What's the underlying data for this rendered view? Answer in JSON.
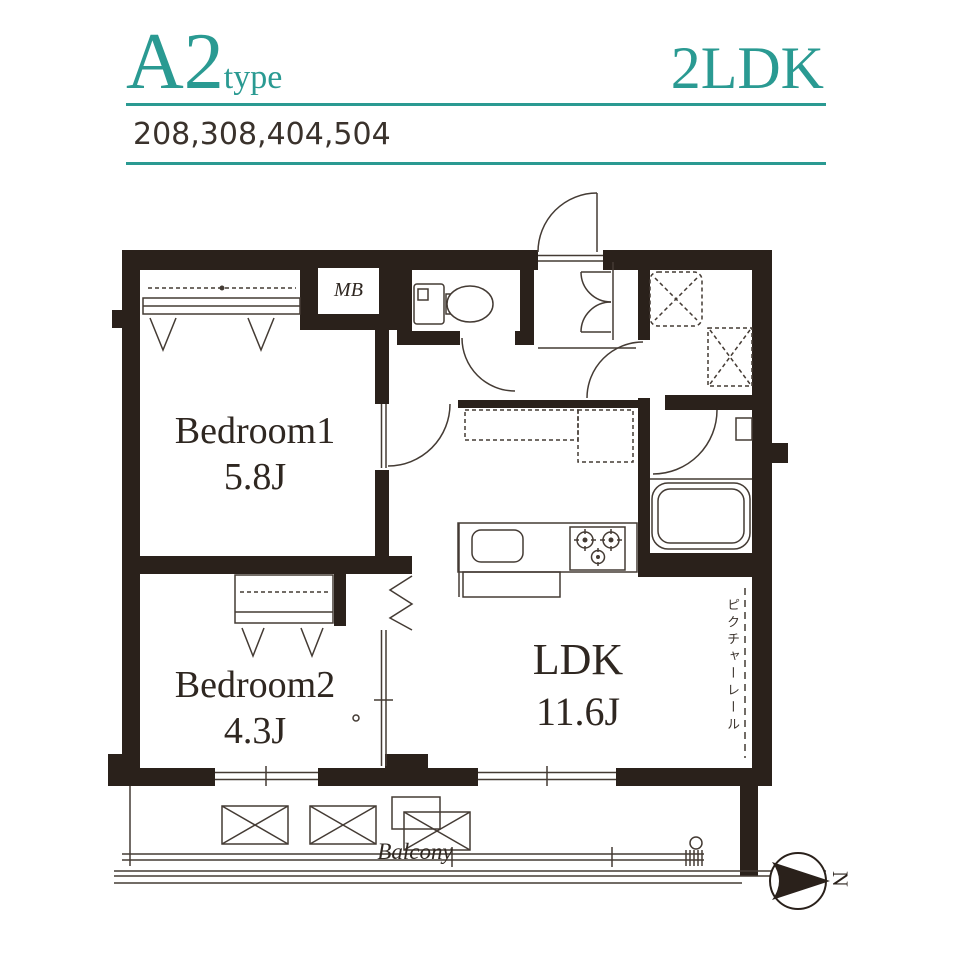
{
  "header": {
    "plan_code": "A2",
    "plan_code_suffix": "type",
    "layout_type": "2LDK",
    "unit_numbers": "208,308,404,504"
  },
  "plan": {
    "labels": {
      "mb": "MB",
      "bedroom1_name": "Bedroom1",
      "bedroom1_size": "5.8J",
      "bedroom2_name": "Bedroom2",
      "bedroom2_size": "4.3J",
      "ldk_name": "LDK",
      "ldk_size": "11.6J",
      "balcony": "Balcony",
      "picture_rail": "ピクチャーレール",
      "compass_north": "N"
    },
    "colors": {
      "accent_teal": "#2a9a92",
      "wall_ink": "#2a211b",
      "thin_line": "#443b34",
      "text_dark": "#322a24"
    }
  }
}
